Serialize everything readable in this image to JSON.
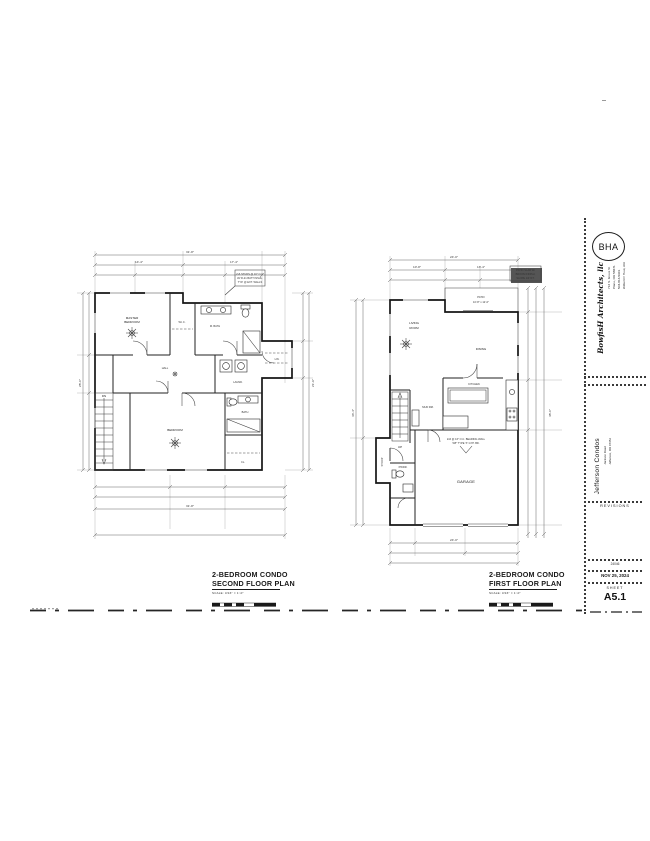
{
  "titleblock": {
    "logo": "BHA",
    "firm": "BowfisH Architects, llc",
    "firm_lines": [
      "712 S. Grove St",
      "Plano, OR 58671",
      "503-813-5901",
      "Wilbert P. Hout, AIA"
    ],
    "project": "Jefferson Condos",
    "project_lines": [
      "Jackson Road",
      "Jefferson, OR 97352"
    ],
    "revisions_label": "REVISIONS",
    "job_no": "24046",
    "date": "NOV 25, 2024",
    "sheet_label": "SHEET",
    "sheet_no": "A5.1"
  },
  "plans": {
    "second": {
      "title1": "2-BEDROOM CONDO",
      "title2": "SECOND FLOOR PLAN",
      "scale": "SCALE: 3/16\" = 1'-0\"",
      "rooms": {
        "master1": "MASTER",
        "master2": "BEDROOM",
        "wic": "W.I.C.",
        "mbath": "M. BATH",
        "hall": "HALL",
        "laund": "LAUND.",
        "lin": "LIN.",
        "bedroom": "BEDROOM",
        "bath": "BATH",
        "cl": "CL.",
        "dn": "DN"
      },
      "dims": {
        "top_overall": "31'-8\"",
        "top_a": "14'-4\"",
        "top_b": "17'-4\"",
        "bottom_overall": "31'-8\"",
        "left": "28'-0\"",
        "right": "21'-6\""
      },
      "note": [
        "2x6 STUDS @ 16\" O.C.",
        "W/ R-21 BATT INSUL.",
        "TYP. @ EXT. WALLS"
      ]
    },
    "first": {
      "title1": "2-BEDROOM CONDO",
      "title2": "FIRST FLOOR PLAN",
      "scale": "SCALE: 3/16\" = 1'-0\"",
      "rooms": {
        "living1": "LIVING",
        "living2": "ROOM",
        "dining": "DINING",
        "kitchen": "KITCHEN",
        "pwdr": "PWDR.",
        "mud": "MUD RM.",
        "garage": "GARAGE",
        "patio": "PATIO",
        "patio_dim": "10'-8\" x 12'-0\"",
        "stoop": "STOOP",
        "up": "UP"
      },
      "dims": {
        "top_overall": "24'-0\"",
        "top_a": "10'-8\"",
        "top_b": "13'-4\"",
        "bottom_overall": "24'-0\"",
        "left": "43'-4\"",
        "right": "48'-0\""
      },
      "note": [
        "PATIO SLAB W/",
        "BROOM FINISH,",
        "SLOPE 1/4\"/FT."
      ],
      "garage_note1": "2x6 @ 16\" O.C. BEARING WALL",
      "garage_note2": "5/8\" TYPE 'X' GYP. BD."
    }
  }
}
